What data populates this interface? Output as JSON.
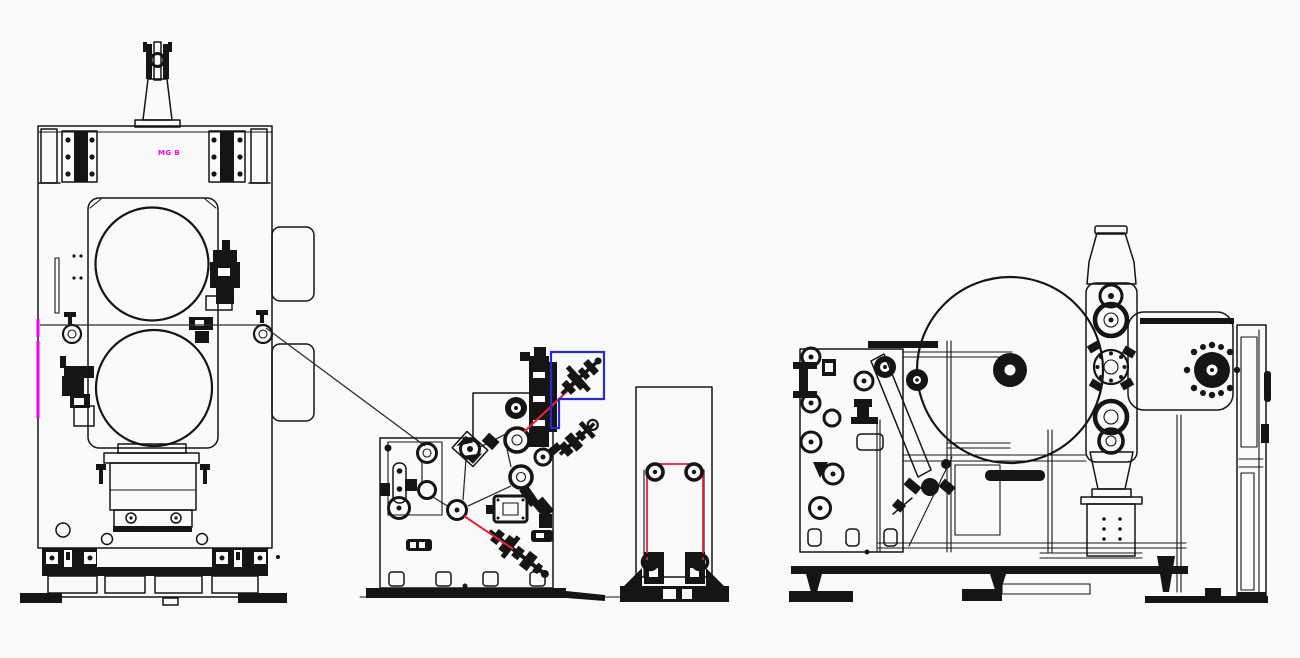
{
  "drawing": {
    "press_label": "MG B"
  },
  "colors": {
    "background": "#fafafa",
    "ink": "#151515",
    "magenta": "#ee00ee",
    "highlight_blue": "#2a2acc",
    "thread_red": "#e82438",
    "web_gray": "#2e2e2e"
  }
}
